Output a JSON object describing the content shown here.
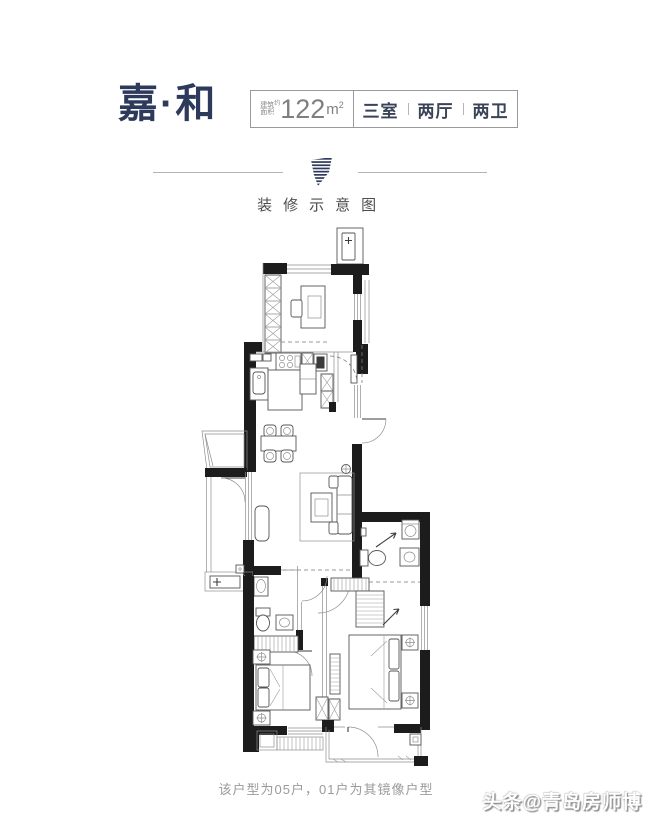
{
  "header": {
    "title": "嘉·和",
    "area_prefix_top": "建筑",
    "area_prefix_bottom": "面积",
    "area_prefix_note": "约",
    "area_value": "122",
    "area_unit": "m",
    "area_sup": "2",
    "rooms": [
      "三室",
      "两厅",
      "两卫"
    ]
  },
  "divider": {
    "label": "装修示意图",
    "icon": "brand-leaf-icon"
  },
  "footer": {
    "caption": "该户型为05户，01户为其镜像户型",
    "watermark": "头条@青岛房师博"
  },
  "colors": {
    "brand_navy": "#2e3a5c",
    "spec_box_border": "#9a9a9a",
    "area_text": "#7f7f7f",
    "rooms_text": "#3a4357",
    "divider_line": "#b3b3b3",
    "caption_text": "#9b9b9b",
    "wall": "#1c1c1c",
    "background": "#ffffff"
  }
}
